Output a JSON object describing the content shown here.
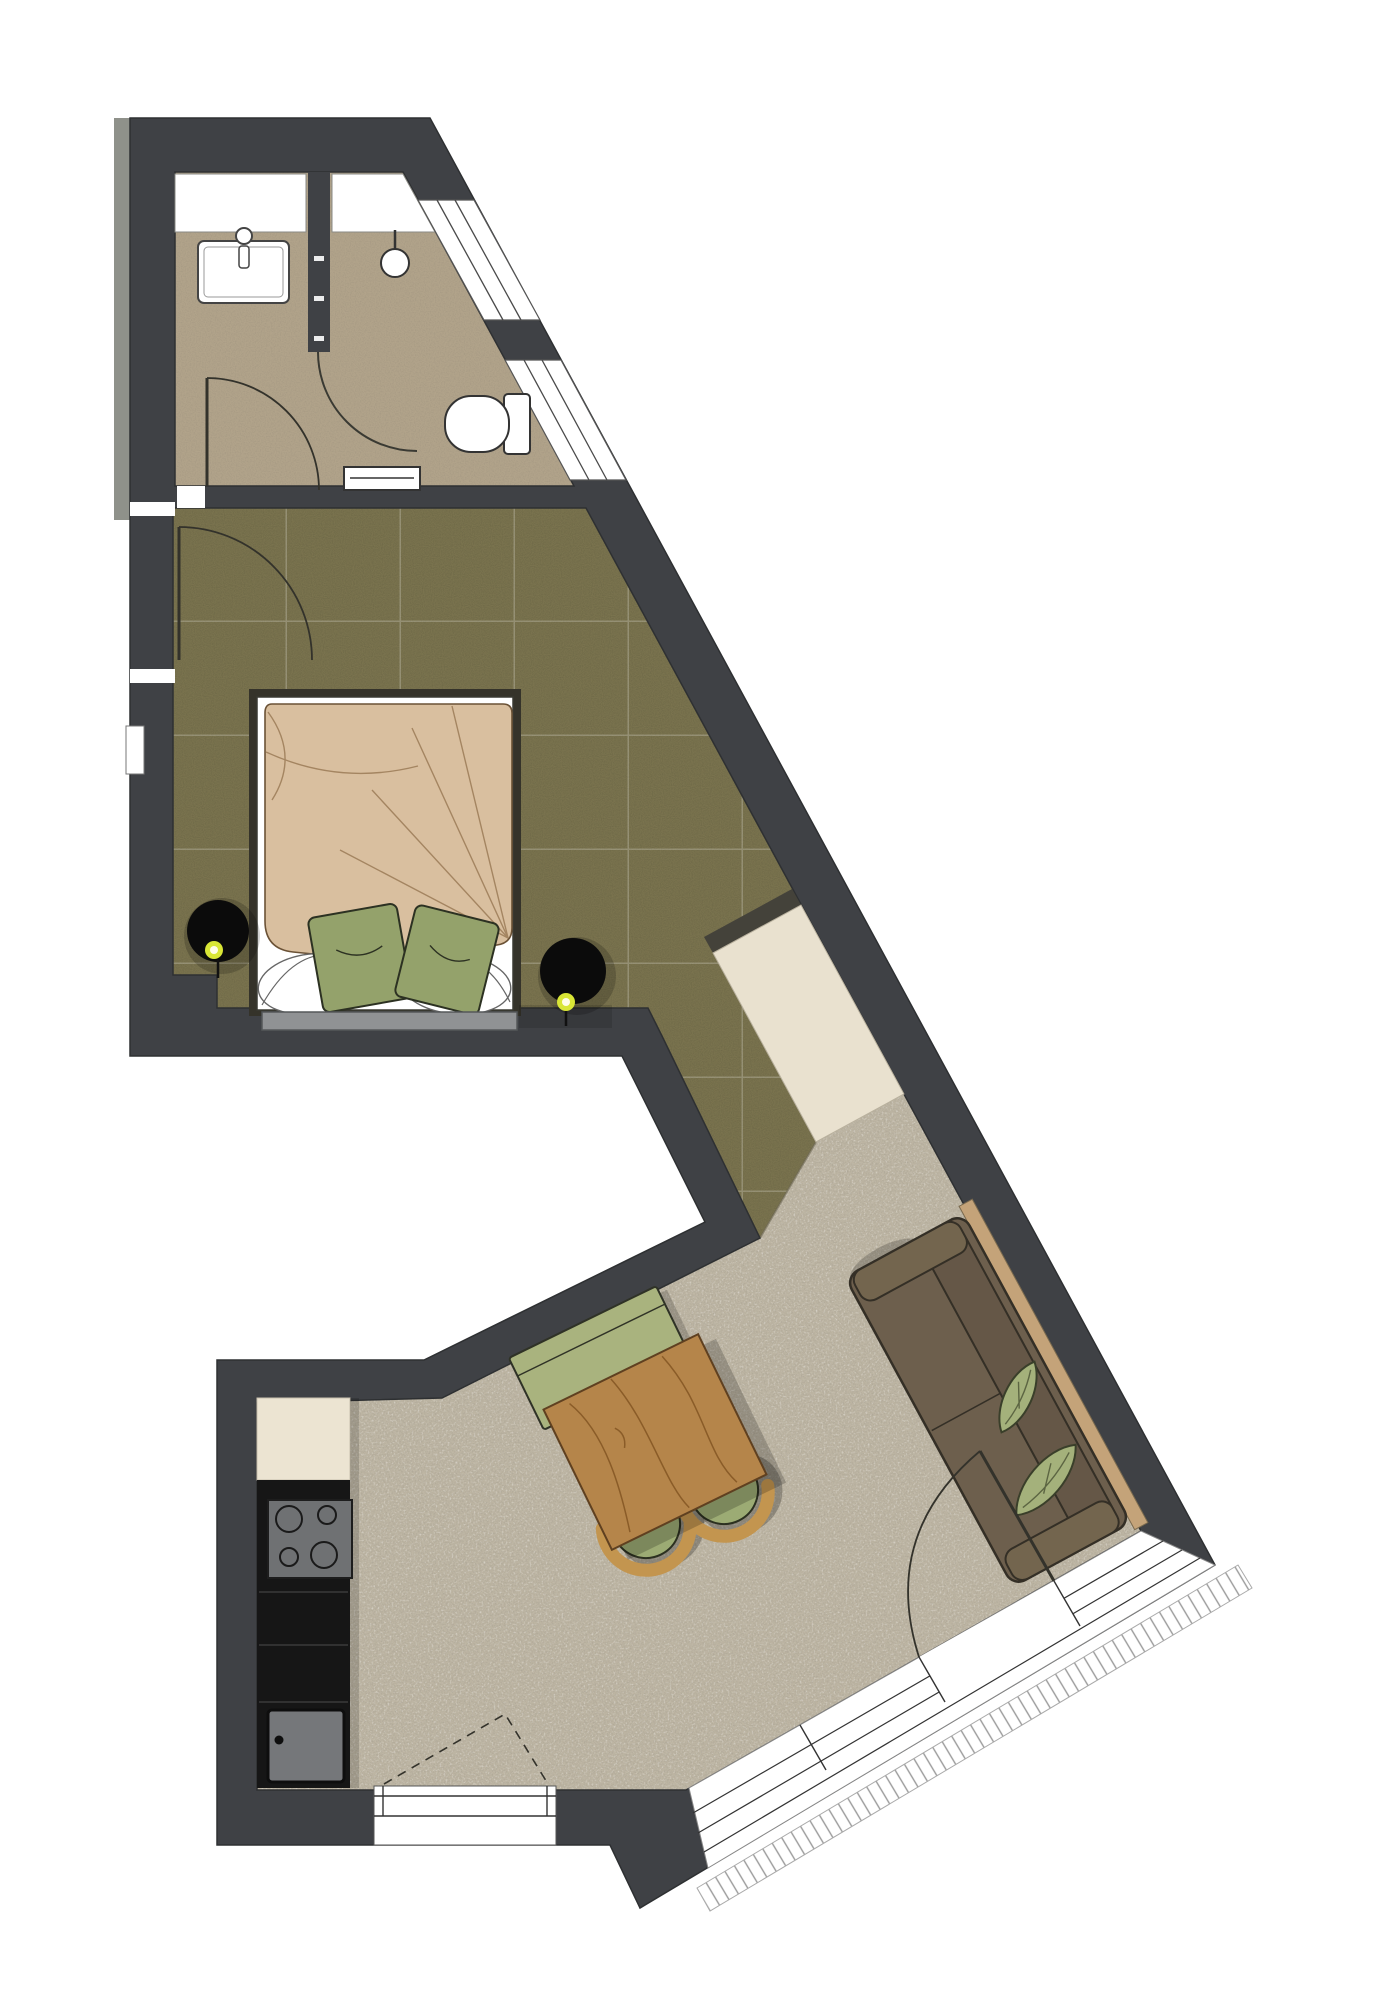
{
  "meta": {
    "type": "architectural-floor-plan",
    "rooms": [
      "bathroom",
      "bedroom",
      "hallway",
      "living-dining",
      "kitchenette",
      "balcony"
    ],
    "furniture": [
      "wash-basin",
      "shower",
      "toilet",
      "towel-radiator",
      "double-bed",
      "green-pillows",
      "bedside-lamp-left",
      "bedside-lamp-right",
      "wardrobe",
      "sofa",
      "leaf-cushions",
      "dining-bench",
      "dining-table",
      "chair",
      "chair",
      "tall-cabinet",
      "cooktop",
      "kitchen-sink",
      "balcony-door",
      "windows",
      "entry-door",
      "bathroom-door",
      "shower-door"
    ]
  },
  "palette": {
    "wall": "#3f4145",
    "wallOuter": "#8f918a",
    "outline": "#2e3032",
    "bathFloor": "#b1a38a",
    "carpet": "#7b744f",
    "livingFloor": "#bdb5a3",
    "white": "#ffffff",
    "wardrobe": "#e9e1cf",
    "wardrobeShadow": "#44423a",
    "counterCream": "#ece4d2",
    "counterBlack": "#161616",
    "cooktop": "#6f7173",
    "appliance": "#75777a",
    "bedShadow": "#35332a",
    "duvet": "#d9bf9f",
    "duvetLine": "#9b7b57",
    "linen": "#ffffff",
    "footboard": "#909294",
    "pillowGreen": "#94a26b",
    "lamp": "#0b0b0b",
    "glow": "#d9e636",
    "glowCore": "#fffde8",
    "sofa": "#6d5f4d",
    "sofaBack": "#655747",
    "sofaArm": "#73654e",
    "sofaTrim": "#c4a379",
    "leaf": "#a4b17b",
    "bench": "#a9b37e",
    "table": "#b5854a",
    "tableGrain": "#8a5c28",
    "chairSeat": "#9cab74",
    "chairWood": "#c3954f",
    "doorLine": "#33322b",
    "glassLine": "#444444",
    "hatchLine": "#9a9a9a"
  }
}
